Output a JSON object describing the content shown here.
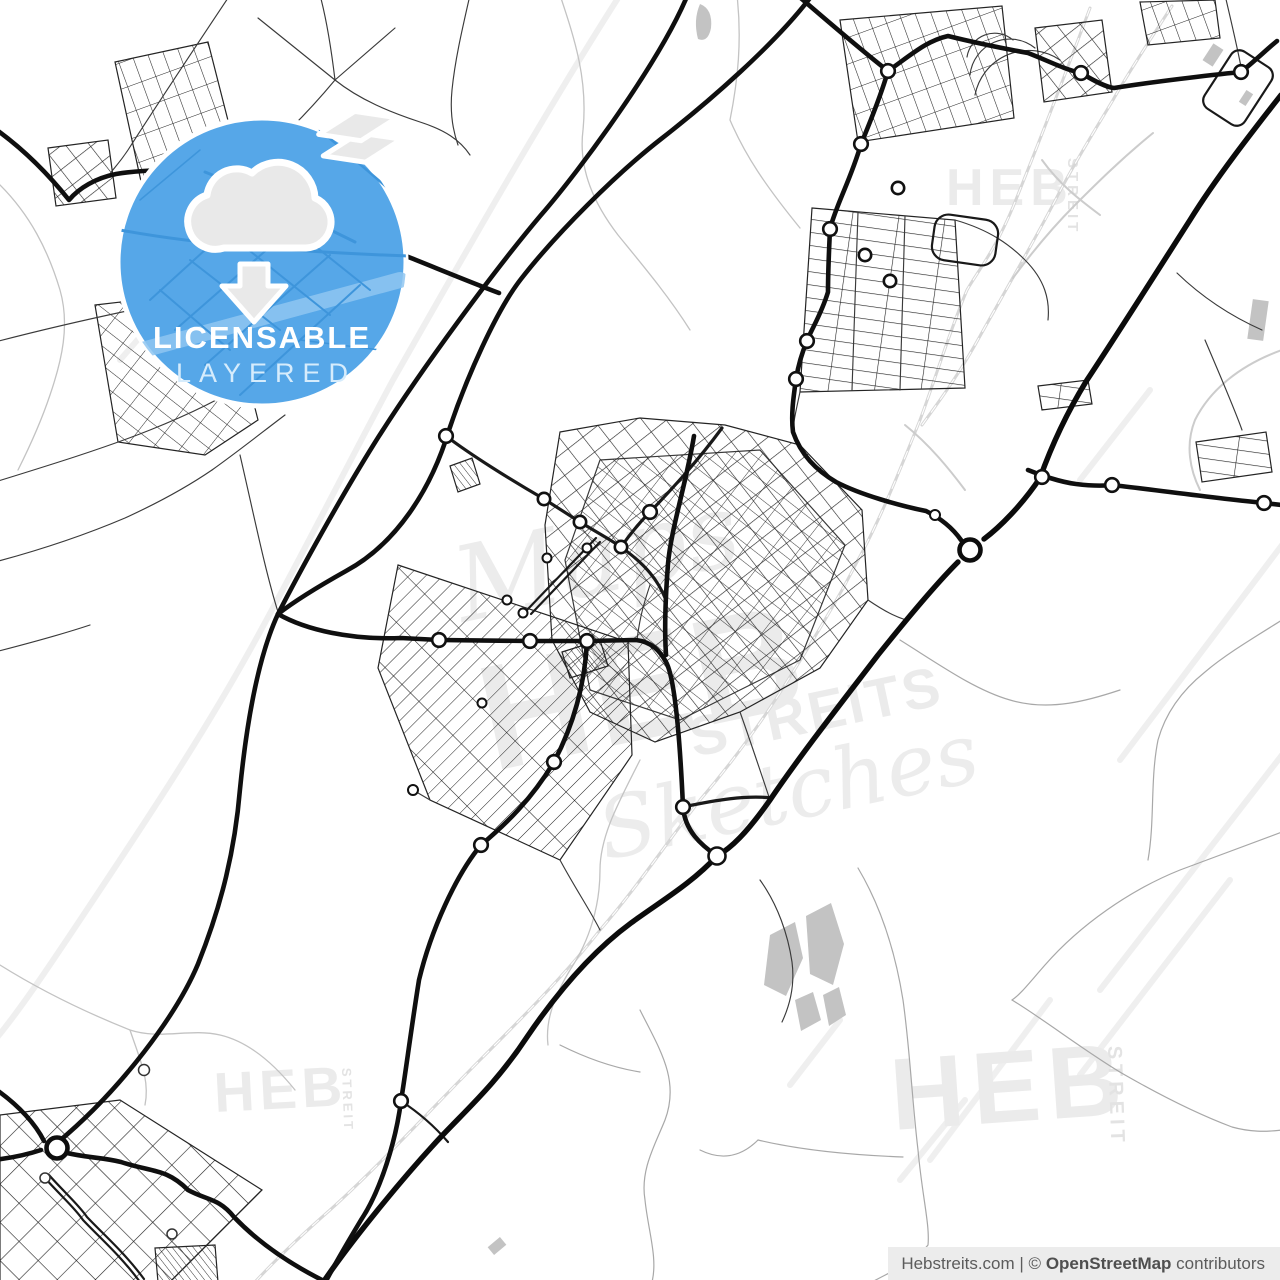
{
  "badge": {
    "line1": "LICENSABLE",
    "line2": "LAYERED"
  },
  "watermarks": {
    "center": {
      "script_top": "Maps",
      "main": "HEB",
      "sub": "STREITS",
      "script_bottom": "Sketches"
    },
    "top_right": {
      "main": "HEB",
      "side": "STREIT"
    },
    "bottom_right": {
      "main": "HEB",
      "side": "STREIT"
    },
    "bottom_left": {
      "main": "HEB",
      "side": "STREIT"
    }
  },
  "attribution": {
    "site": "Hebstreits.com",
    "separator": " | © ",
    "brand": "OpenStreetMap",
    "suffix": " contributors"
  },
  "colors": {
    "badge_blue": "#56a7e8",
    "badge_title": "#ffffff",
    "badge_subtitle": "#d6ecfc",
    "road_black": "#0f0f0f",
    "railway_gray": "#d6d6d6",
    "watermark_gray": "#ebebeb",
    "attribution_bg": "#ececec",
    "attribution_text": "#5c5c5c"
  }
}
